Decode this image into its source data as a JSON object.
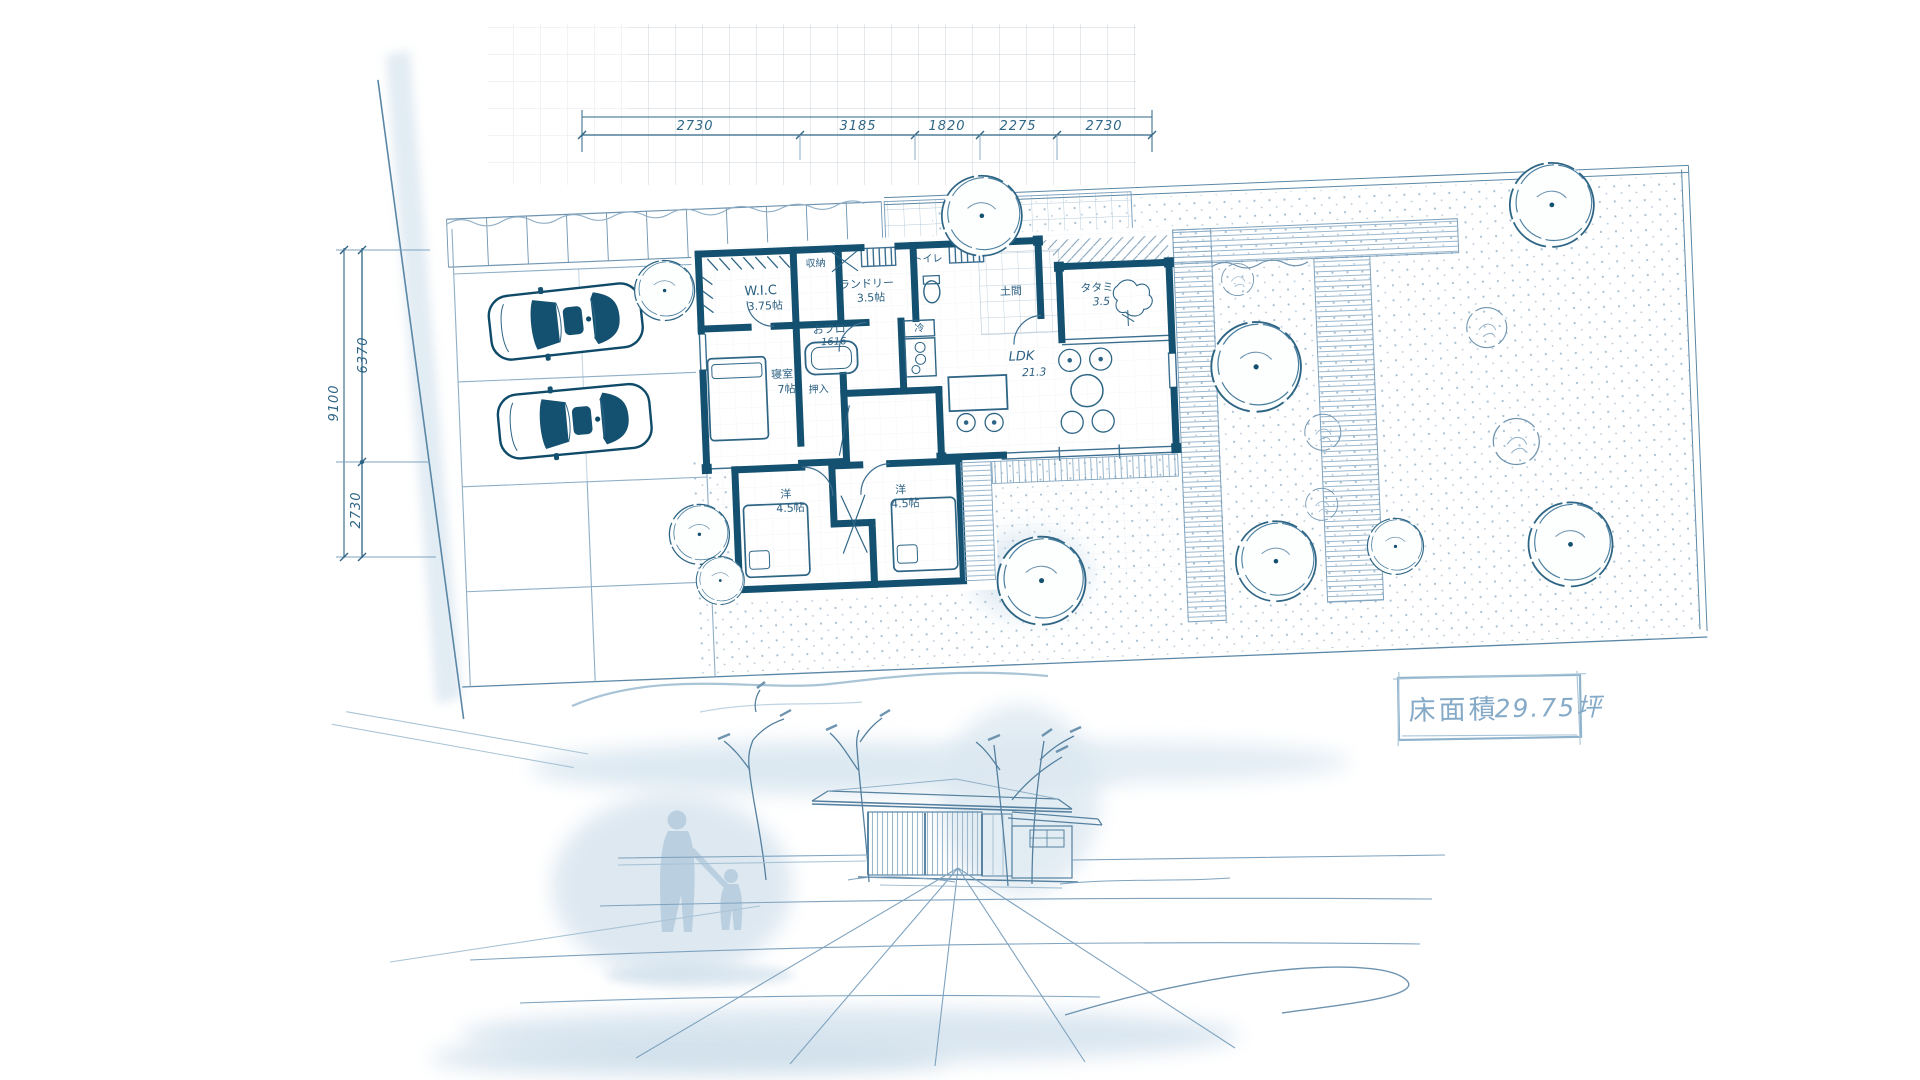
{
  "document": {
    "kind": "hand-drawn architectural site & floor plan sketch with perspective view",
    "colors": {
      "wall_ink": "#14506f",
      "line_ink": "#2e6585",
      "light_ink": "#7fa3bf",
      "pale_ink": "#a9c4d6",
      "wash": "#d3e2ed",
      "grid": "#c7ccd3",
      "paper": "#ffffff"
    }
  },
  "dimensions": {
    "top": [
      "2730",
      "3185",
      "1820",
      "2275",
      "2730"
    ],
    "left": {
      "total": "9100",
      "upper": "6370",
      "lower": "2730"
    }
  },
  "rooms": {
    "wic": {
      "name": "W.I.C",
      "size": "3.75帖"
    },
    "closet_top": {
      "name": "収納"
    },
    "laundry": {
      "name": "ランドリー",
      "size": "3.5帖"
    },
    "toilet": {
      "name": "トイレ"
    },
    "fridge": {
      "name": "冷"
    },
    "bath": {
      "name": "おフロ",
      "size": "1616"
    },
    "doma": {
      "name": "土間"
    },
    "tatami": {
      "name": "タタミ",
      "size": "3.5"
    },
    "ldk": {
      "name": "LDK",
      "size": "21.3"
    },
    "bedroom": {
      "name": "寝室",
      "size": "7帖"
    },
    "oshiire": {
      "name": "押入"
    },
    "west_room_a": {
      "name": "洋",
      "size": "4.5帖"
    },
    "west_room_b": {
      "name": "洋",
      "size": "4.5帖"
    }
  },
  "area_box": {
    "label": "床面積",
    "value": "29.75坪"
  }
}
